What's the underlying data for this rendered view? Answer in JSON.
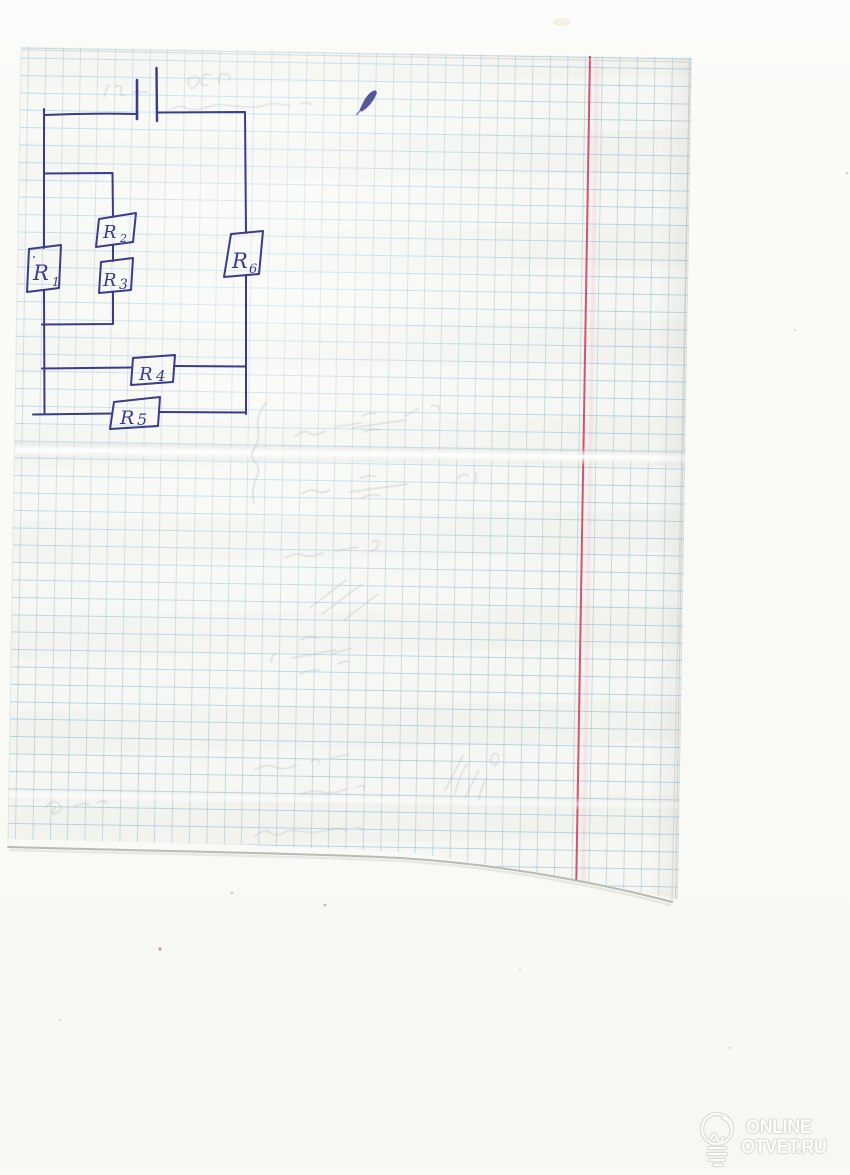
{
  "colors": {
    "ink": "#3b3b8c",
    "grid_line": "#b9dbe9",
    "paper": "#f6f6f2",
    "scanner_background": "#fafaf7",
    "margin_line": "#d63a55",
    "pencil_ghost": "#b1b1b6",
    "watermark_fill": "#fdfdfa",
    "watermark_outline": "#d6d6d1"
  },
  "circuit": {
    "battery": {
      "symbol_name": "battery-icon"
    },
    "resistors": [
      {
        "letter": "R",
        "sub": "1"
      },
      {
        "letter": "R",
        "sub": "2"
      },
      {
        "letter": "R",
        "sub": "3"
      },
      {
        "letter": "R",
        "sub": "4"
      },
      {
        "letter": "R",
        "sub": "5"
      },
      {
        "letter": "R",
        "sub": "6"
      }
    ]
  },
  "watermark": {
    "icon": "lightbulb-icon",
    "line1": "ONLINE",
    "line2": "OTVET.RU"
  }
}
